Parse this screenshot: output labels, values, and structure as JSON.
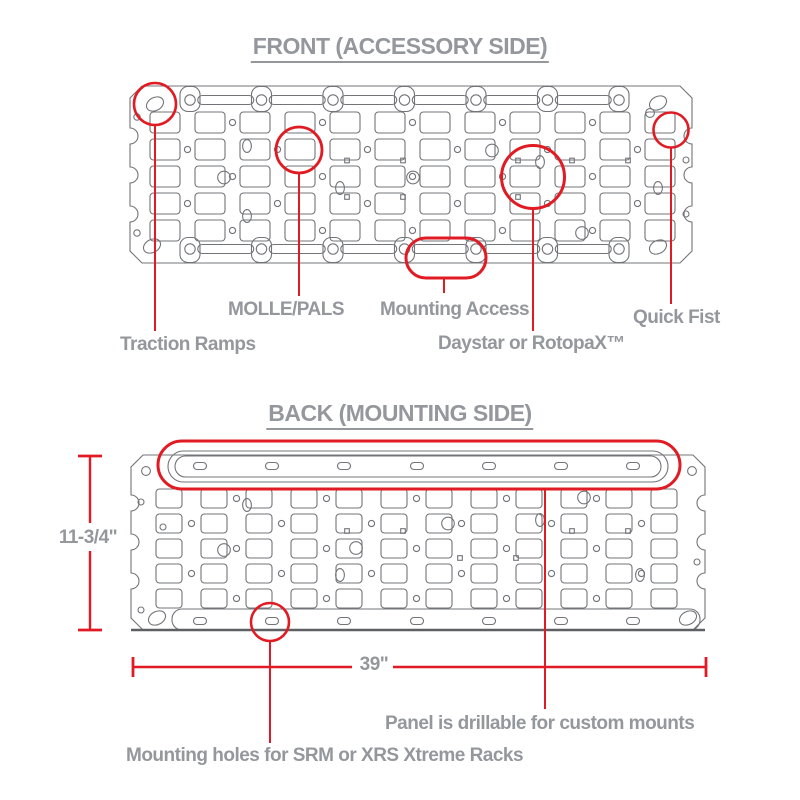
{
  "colors": {
    "red": "#e11b23",
    "panel_line": "#737478",
    "panel_dark": "#5f6063",
    "text": "#94979c",
    "background": "#ffffff"
  },
  "front": {
    "title": "FRONT (ACCESSORY SIDE)",
    "callouts": [
      {
        "label": "Traction Ramps"
      },
      {
        "label": "MOLLE/PALS"
      },
      {
        "label": "Mounting Access"
      },
      {
        "label": "Daystar or RotopaX™"
      },
      {
        "label": "Quick Fist"
      }
    ]
  },
  "back": {
    "title": "BACK (MOUNTING SIDE)",
    "dimensions": {
      "height": "11-3/4\"",
      "width": "39\""
    },
    "callouts": [
      {
        "label": "Panel is drillable for custom mounts"
      },
      {
        "label": "Mounting holes for SRM or XRS Xtreme Racks"
      }
    ]
  }
}
